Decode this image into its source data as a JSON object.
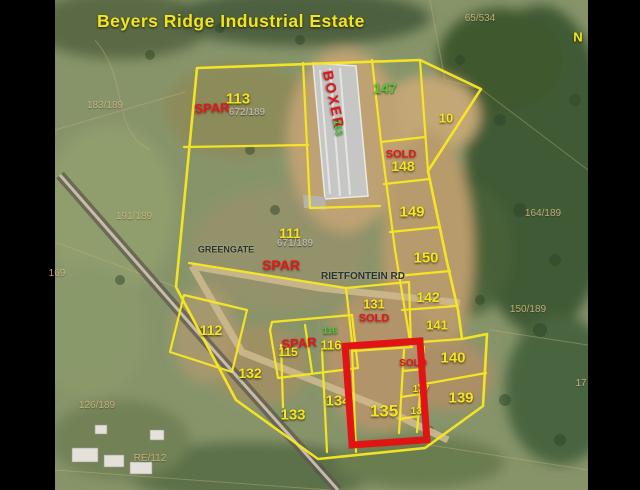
{
  "title": "Beyers Ridge Industrial Estate",
  "highlight": {
    "plot": "135",
    "shape": "red-rectangle"
  },
  "colors": {
    "plot_outline": "#f7e822",
    "highlight_box": "#e11414",
    "title_yellow": "#f2e41d",
    "label_yellow": "#f6e41e",
    "label_green": "#56c93c",
    "label_red": "#e01818",
    "label_gray": "#b7b3a4",
    "label_dark": "#2b332c",
    "label_tan": "#cdb77c"
  },
  "map_labels": [
    {
      "name": "plot-label-113",
      "text": "113",
      "x": 238,
      "y": 99,
      "size": 15,
      "color": "yellow"
    },
    {
      "name": "brand-label-spar-113",
      "text": "SPAR",
      "x": 212,
      "y": 108,
      "size": 13,
      "color": "red",
      "rot": -2
    },
    {
      "name": "parcel-ref-672-189",
      "text": "672/189",
      "x": 247,
      "y": 113,
      "size": 10,
      "color": "gray"
    },
    {
      "name": "brand-label-boxer",
      "text": "BOXER",
      "x": 334,
      "y": 100,
      "size": 14,
      "color": "red",
      "rot": 78,
      "ls": 2
    },
    {
      "name": "plot-label-153",
      "text": "153",
      "x": 337,
      "y": 128,
      "size": 10,
      "color": "green",
      "rot": 78
    },
    {
      "name": "plot-label-147",
      "text": "147",
      "x": 385,
      "y": 88,
      "size": 14,
      "color": "green"
    },
    {
      "name": "plot-label-10",
      "text": "10",
      "x": 446,
      "y": 118,
      "size": 13,
      "color": "yellow"
    },
    {
      "name": "sold-badge-148",
      "text": "SOLD",
      "x": 401,
      "y": 155,
      "size": 11,
      "color": "red"
    },
    {
      "name": "plot-label-148",
      "text": "148",
      "x": 403,
      "y": 166,
      "size": 14,
      "color": "yellow"
    },
    {
      "name": "plot-label-149",
      "text": "149",
      "x": 412,
      "y": 212,
      "size": 15,
      "color": "yellow"
    },
    {
      "name": "plot-label-150",
      "text": "150",
      "x": 426,
      "y": 258,
      "size": 15,
      "color": "yellow"
    },
    {
      "name": "plot-label-142",
      "text": "142",
      "x": 428,
      "y": 297,
      "size": 14,
      "color": "yellow"
    },
    {
      "name": "plot-label-141",
      "text": "141",
      "x": 437,
      "y": 325,
      "size": 13,
      "color": "yellow"
    },
    {
      "name": "plot-label-140",
      "text": "140",
      "x": 453,
      "y": 358,
      "size": 15,
      "color": "yellow"
    },
    {
      "name": "plot-label-139",
      "text": "139",
      "x": 461,
      "y": 398,
      "size": 15,
      "color": "yellow"
    },
    {
      "name": "plot-label-111",
      "text": "111",
      "x": 290,
      "y": 233,
      "size": 14,
      "color": "yellow"
    },
    {
      "name": "parcel-ref-671-189",
      "text": "671/189",
      "x": 295,
      "y": 244,
      "size": 10,
      "color": "gray"
    },
    {
      "name": "brand-label-spar-111",
      "text": "SPAR",
      "x": 281,
      "y": 265,
      "size": 14,
      "color": "red"
    },
    {
      "name": "road-label-greengate",
      "text": "GREENGATE",
      "x": 226,
      "y": 250,
      "size": 9,
      "color": "dark"
    },
    {
      "name": "road-label-rietfontein",
      "text": "RIETFONTEIN RD",
      "x": 363,
      "y": 277,
      "size": 10,
      "color": "dark"
    },
    {
      "name": "plot-label-131",
      "text": "131",
      "x": 374,
      "y": 304,
      "size": 13,
      "color": "yellow"
    },
    {
      "name": "sold-badge-131",
      "text": "SOLD",
      "x": 374,
      "y": 319,
      "size": 11,
      "color": "red"
    },
    {
      "name": "plot-label-112",
      "text": "112",
      "x": 211,
      "y": 330,
      "size": 14,
      "color": "yellow"
    },
    {
      "name": "brand-label-spar-115",
      "text": "SPAR",
      "x": 299,
      "y": 343,
      "size": 13,
      "color": "red",
      "rot": -4
    },
    {
      "name": "plot-label-115",
      "text": "115",
      "x": 288,
      "y": 352,
      "size": 12,
      "color": "yellow"
    },
    {
      "name": "plot-label-116-green",
      "text": "116",
      "x": 330,
      "y": 331,
      "size": 9,
      "color": "green"
    },
    {
      "name": "plot-label-116",
      "text": "116",
      "x": 331,
      "y": 345,
      "size": 13,
      "color": "yellow"
    },
    {
      "name": "plot-label-132",
      "text": "132",
      "x": 250,
      "y": 373,
      "size": 14,
      "color": "yellow"
    },
    {
      "name": "plot-label-133",
      "text": "133",
      "x": 293,
      "y": 415,
      "size": 15,
      "color": "yellow"
    },
    {
      "name": "plot-label-134",
      "text": "134",
      "x": 338,
      "y": 401,
      "size": 15,
      "color": "yellow"
    },
    {
      "name": "plot-label-135",
      "text": "135",
      "x": 384,
      "y": 411,
      "size": 17,
      "color": "yellow"
    },
    {
      "name": "sold-badge-136",
      "text": "SOLD",
      "x": 413,
      "y": 364,
      "size": 10,
      "color": "red"
    },
    {
      "name": "plot-label-137",
      "text": "137",
      "x": 421,
      "y": 390,
      "size": 10,
      "color": "yellow"
    },
    {
      "name": "plot-label-138",
      "text": "138",
      "x": 419,
      "y": 412,
      "size": 10,
      "color": "yellow"
    },
    {
      "name": "north-indicator",
      "text": "N",
      "x": 578,
      "y": 37,
      "size": 13,
      "color": "yellow"
    },
    {
      "name": "parcel-ref-65-534",
      "text": "65/534",
      "x": 480,
      "y": 19,
      "size": 10,
      "color": "tan"
    },
    {
      "name": "parcel-ref-183-189",
      "text": "183/189",
      "x": 105,
      "y": 106,
      "size": 10,
      "color": "tan"
    },
    {
      "name": "parcel-ref-191-189",
      "text": "191/189",
      "x": 134,
      "y": 217,
      "size": 10,
      "color": "tan"
    },
    {
      "name": "parcel-ref-169",
      "text": "169",
      "x": 57,
      "y": 274,
      "size": 10,
      "color": "tan"
    },
    {
      "name": "parcel-ref-164-189",
      "text": "164/189",
      "x": 543,
      "y": 214,
      "size": 10,
      "color": "tan"
    },
    {
      "name": "parcel-ref-150-189",
      "text": "150/189",
      "x": 528,
      "y": 310,
      "size": 10,
      "color": "tan"
    },
    {
      "name": "parcel-ref-126-189",
      "text": "126/189",
      "x": 97,
      "y": 406,
      "size": 10,
      "color": "tan"
    },
    {
      "name": "parcel-ref-re-112",
      "text": "RE/112",
      "x": 150,
      "y": 459,
      "size": 10,
      "color": "tan"
    },
    {
      "name": "parcel-ref-17",
      "text": "17",
      "x": 581,
      "y": 384,
      "size": 10,
      "color": "tan"
    }
  ]
}
